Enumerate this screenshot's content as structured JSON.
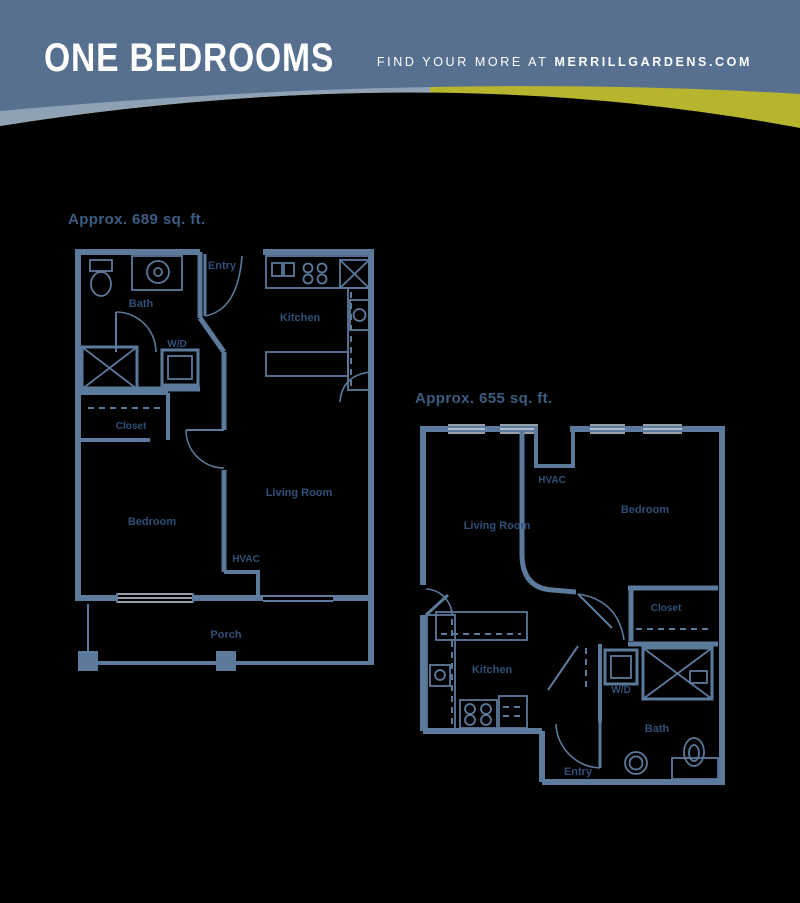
{
  "header": {
    "title": "ONE BEDROOMS",
    "tagline_prefix": "FIND YOUR MORE AT",
    "tagline_brand": "MERRILLGARDENS.COM"
  },
  "plan1": {
    "area_label": "Approx. 689 sq. ft.",
    "rooms": {
      "bath": "Bath",
      "entry": "Entry",
      "kitchen": "Kitchen",
      "wd": "W/D",
      "closet": "Closet",
      "bedroom": "Bedroom",
      "living_room": "Living Room",
      "hvac": "HVAC",
      "porch": "Porch"
    }
  },
  "plan2": {
    "area_label": "Approx. 655 sq. ft.",
    "rooms": {
      "hvac": "HVAC",
      "living_room": "Living Room",
      "bedroom": "Bedroom",
      "closet": "Closet",
      "kitchen": "Kitchen",
      "wd": "W/D",
      "bath": "Bath",
      "entry": "Entry"
    }
  },
  "colors": {
    "background": "#000000",
    "header_blue": "#57708f",
    "band_light_blue": "#8ea1b5",
    "band_yellow": "#b7b42e",
    "wall_line": "#5c7a9c",
    "room_text": "#2f5078",
    "window_stripe": "#c9d5e2",
    "header_text": "#ffffff"
  }
}
